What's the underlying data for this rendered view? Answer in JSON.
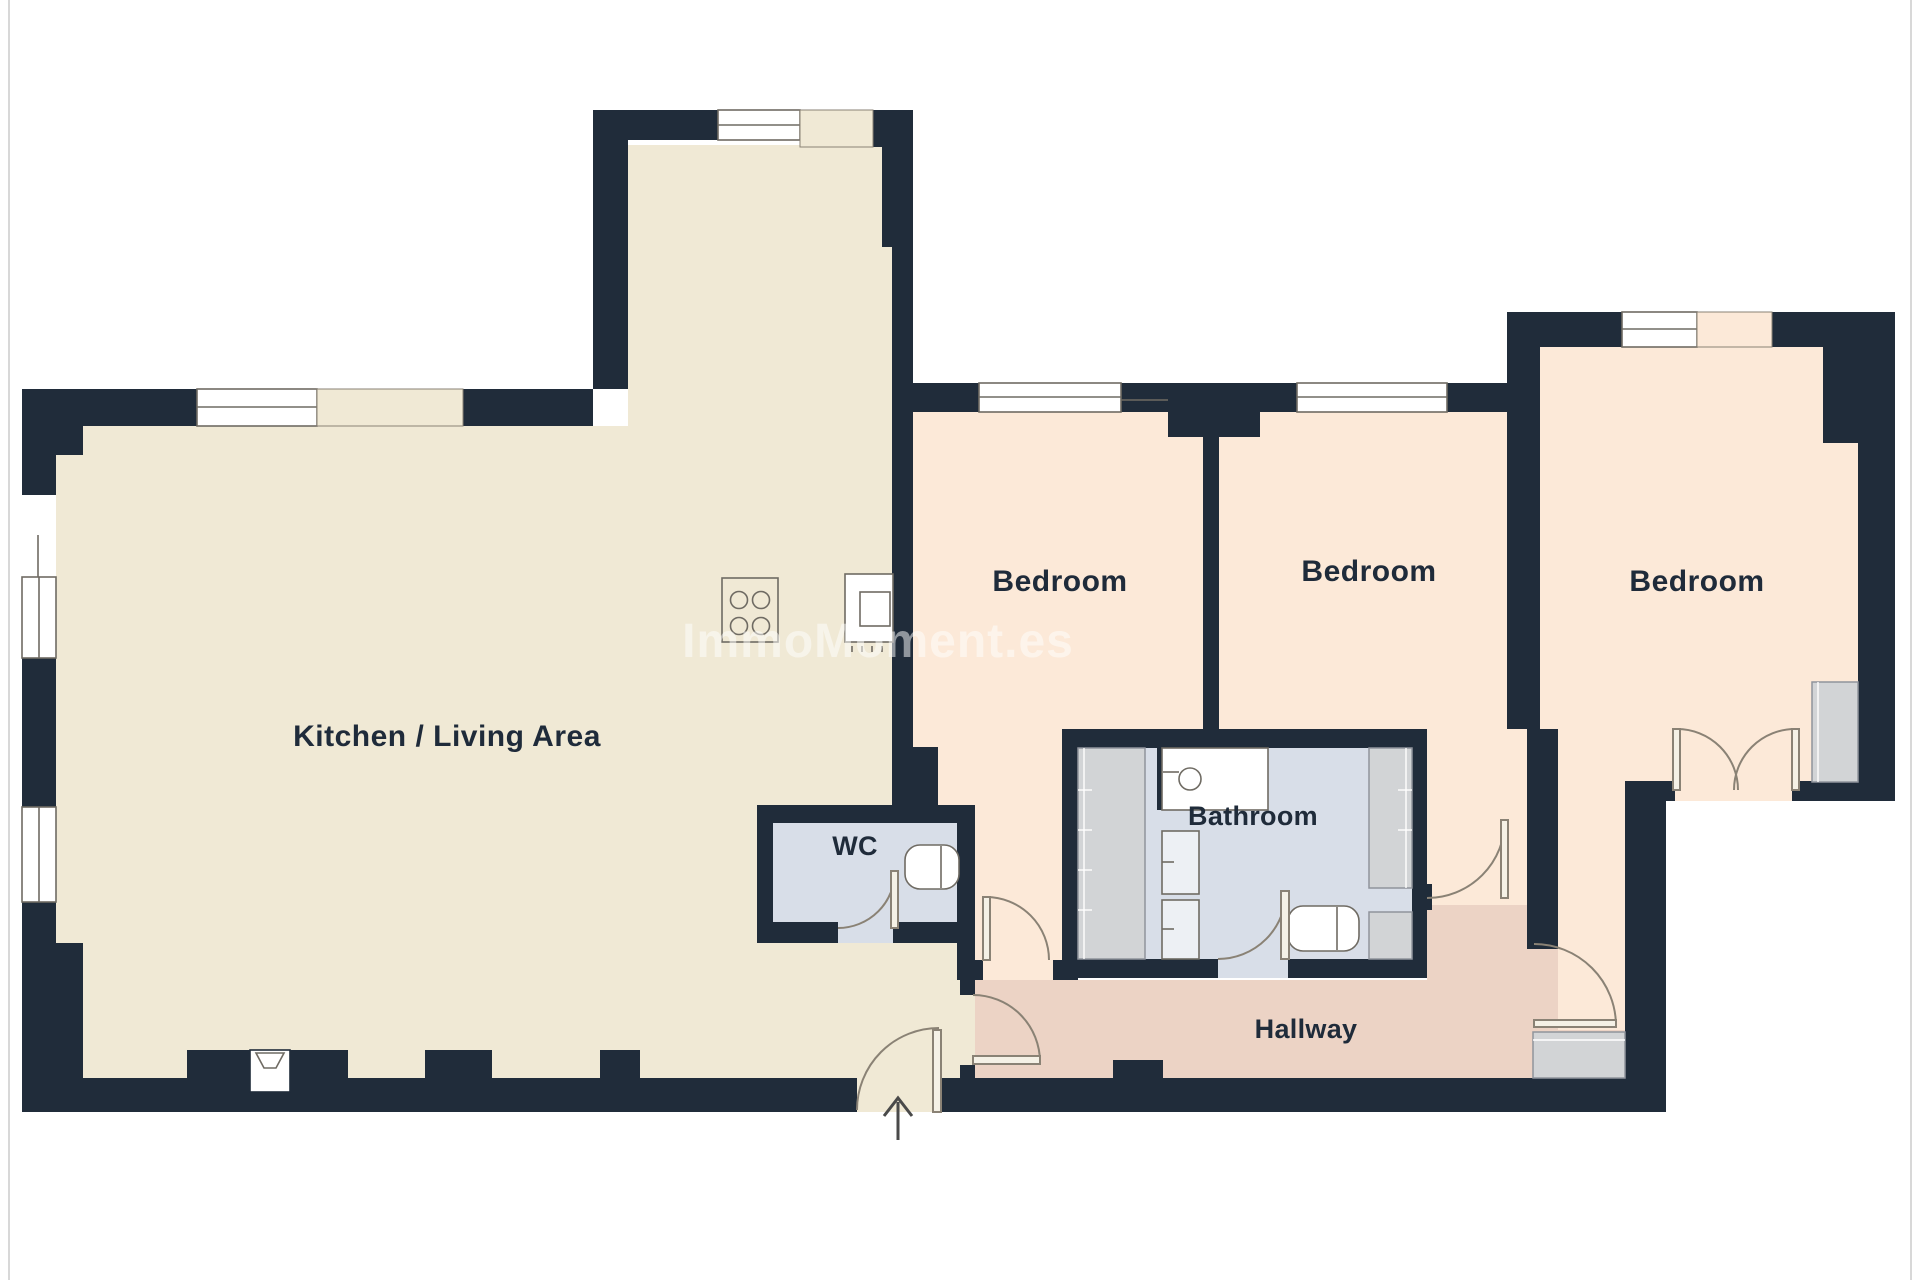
{
  "watermark": "ImmoMoment.es",
  "rooms": {
    "kitchen": {
      "label": "Kitchen / Living Area"
    },
    "bedroom1": {
      "label": "Bedroom"
    },
    "bedroom2": {
      "label": "Bedroom"
    },
    "bedroom3": {
      "label": "Bedroom"
    },
    "bathroom": {
      "label": "Bathroom"
    },
    "wc": {
      "label": "WC"
    },
    "hallway": {
      "label": "Hallway"
    }
  },
  "colors": {
    "wall": "#202c3a",
    "kitchen_floor": "#f0e9d5",
    "bedroom_floor": "#fce9d8",
    "hallway_floor": "#ecd3c5",
    "wet_floor": "#d8dee8",
    "closet": "#d2d4d6",
    "fixture": "#edf0f4",
    "outline": "#6f6b63",
    "door_line": "#8a8275",
    "door_leaf": "#f5f1e6",
    "window_white": "#ffffff",
    "label": "#1f2b3a",
    "watermark_color": "#ffffff",
    "page_edge": "#d8d8d8",
    "arrow": "#4a4a4a"
  }
}
